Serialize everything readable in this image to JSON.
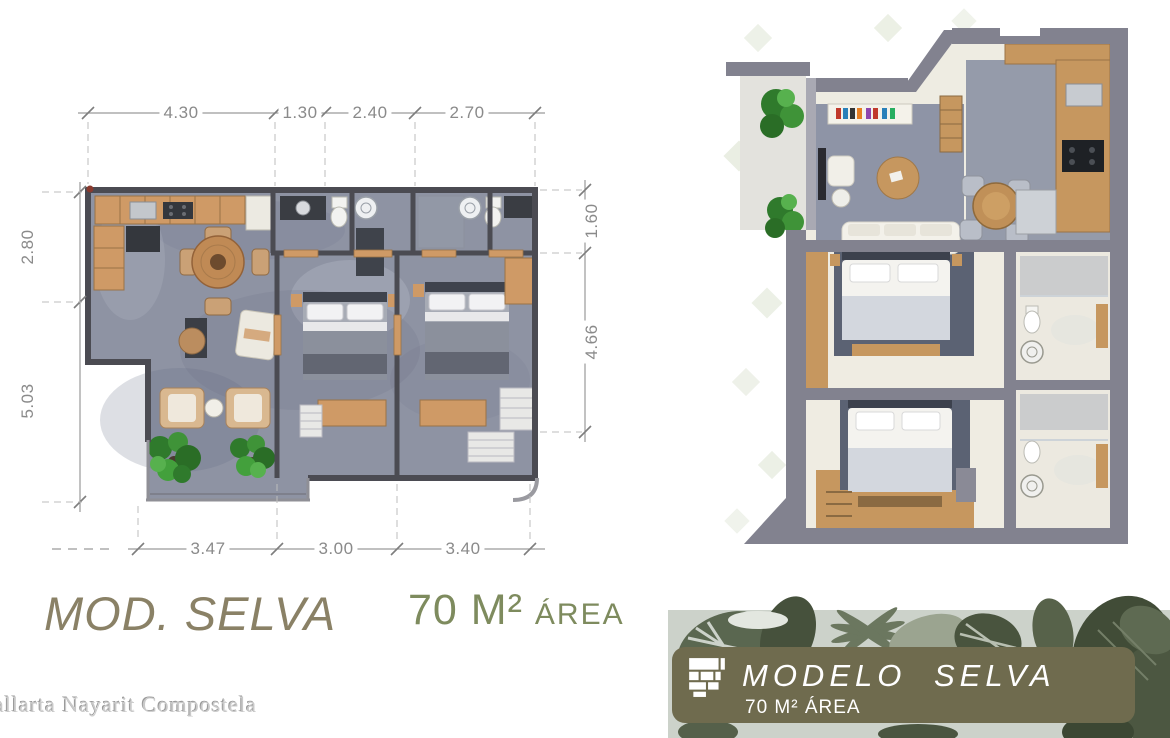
{
  "plan2d": {
    "title": "MOD. SELVA",
    "area": {
      "value": "70 M²",
      "label": "ÁREA"
    },
    "dims": {
      "top": [
        "4.30",
        "1.30",
        "2.40",
        "2.70"
      ],
      "left": [
        "2.80",
        "5.03"
      ],
      "right": [
        "1.60",
        "4.66"
      ],
      "bottom": [
        "3.47",
        "3.00",
        "3.40"
      ]
    }
  },
  "watermark": {
    "text": "allarta Nayarit Compostela"
  },
  "banner": {
    "logo": "stacked-planks-logo",
    "model_label": "MODELO",
    "model_name": "SELVA",
    "area_line": "70 M² ÁREA"
  },
  "colors": {
    "title_olive": "#8a8166",
    "area_green": "#7e8b5e",
    "dim_gray": "#8a8a8a",
    "banner_panel": "#6f6b4e",
    "banner_text": "#ffffff",
    "leaf_bg": "#ccd2ca",
    "plan_wall": "#4b4b52",
    "plan_floor": "#8e93a3",
    "wood": "#cf9a66",
    "render_wall": "#82828f"
  }
}
